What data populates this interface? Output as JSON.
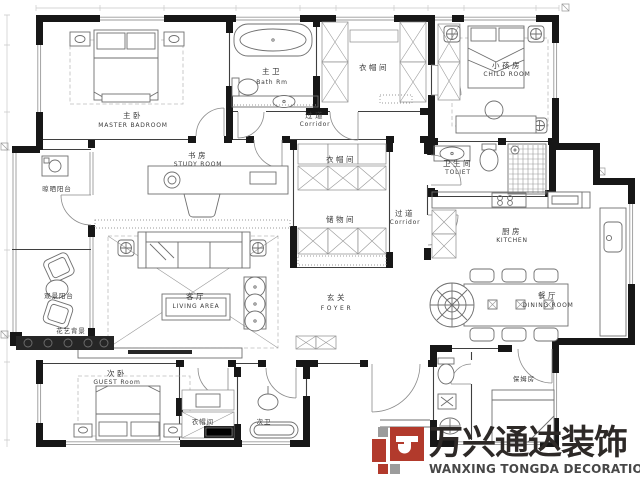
{
  "rooms": {
    "master": {
      "zh": "主卧",
      "en": "MASTER BADROOM"
    },
    "bath_master": {
      "zh": "主卫",
      "en": "Bath Rm"
    },
    "closet_top": {
      "zh": "衣帽间"
    },
    "corridor_top": {
      "zh": "过道",
      "en": "Corridor"
    },
    "child": {
      "zh": "小孩房",
      "en": "CHILD ROOM"
    },
    "toilet": {
      "zh": "卫生间",
      "en": "TOLIET"
    },
    "study": {
      "zh": "书房",
      "en": "STUDY ROOM"
    },
    "drying_balcony": {
      "zh": "晾晒阳台"
    },
    "closet_mid": {
      "zh": "衣帽间"
    },
    "storage": {
      "zh": "储物间"
    },
    "corridor_mid": {
      "zh": "过道",
      "en": "Corridor"
    },
    "kitchen": {
      "zh": "厨房",
      "en": "KITCHEN"
    },
    "living": {
      "zh": "客厅",
      "en": "LIVING AREA"
    },
    "foyer": {
      "zh": "玄关",
      "en": "FOYER"
    },
    "dining": {
      "zh": "餐厅",
      "en": "DINING ROOM"
    },
    "view_balcony": {
      "zh": "观景阳台"
    },
    "flower_bg": {
      "zh": "花艺背景"
    },
    "guest": {
      "zh": "次卧",
      "en": "GUEST Room"
    },
    "closet_bottom": {
      "zh": "衣帽间"
    },
    "bath_second": {
      "zh": "次卫"
    },
    "nanny": {
      "zh": "保姆房"
    }
  },
  "logo": {
    "brand_zh": "万兴通达装饰",
    "brand_en": "WANXING TONGDA DECORATION",
    "colors": {
      "red": "#b23a2c",
      "gray": "#9c9c9c",
      "text": "#2d2927"
    }
  }
}
